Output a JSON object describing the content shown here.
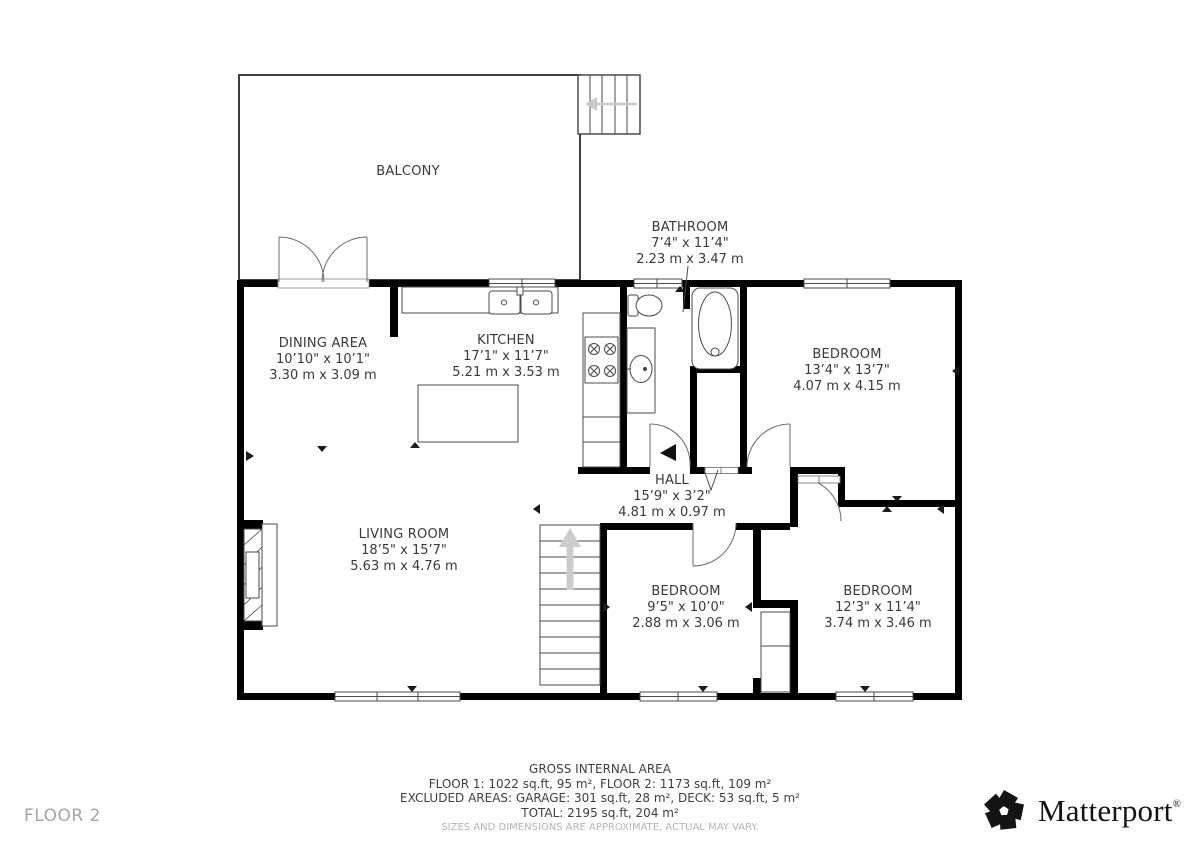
{
  "floor_label": "FLOOR 2",
  "rooms": [
    {
      "id": "balcony",
      "name": "BALCONY",
      "imperial": "",
      "metric": ""
    },
    {
      "id": "bathroom",
      "name": "BATHROOM",
      "imperial": "7’4\" x 11’4\"",
      "metric": "2.23 m x 3.47 m"
    },
    {
      "id": "dining",
      "name": "DINING AREA",
      "imperial": "10’10\" x 10’1\"",
      "metric": "3.30 m x 3.09 m"
    },
    {
      "id": "kitchen",
      "name": "KITCHEN",
      "imperial": "17’1\" x 11’7\"",
      "metric": "5.21 m x 3.53 m"
    },
    {
      "id": "bedroom-ne",
      "name": "BEDROOM",
      "imperial": "13’4\" x 13’7\"",
      "metric": "4.07 m x 4.15 m"
    },
    {
      "id": "hall",
      "name": "HALL",
      "imperial": "15’9\" x 3’2\"",
      "metric": "4.81 m x 0.97 m"
    },
    {
      "id": "living",
      "name": "LIVING ROOM",
      "imperial": "18’5\" x 15’7\"",
      "metric": "5.63 m x 4.76 m"
    },
    {
      "id": "bedroom-s",
      "name": "BEDROOM",
      "imperial": "9’5\" x 10’0\"",
      "metric": "2.88 m x 3.06 m"
    },
    {
      "id": "bedroom-se",
      "name": "BEDROOM",
      "imperial": "12’3\" x 11’4\"",
      "metric": "3.74 m x 3.46 m"
    }
  ],
  "footer": {
    "title": "GROSS INTERNAL AREA",
    "floors": "FLOOR 1: 1022 sq.ft, 95 m², FLOOR 2: 1173 sq.ft, 109 m²",
    "excluded": "EXCLUDED AREAS: GARAGE: 301 sq.ft, 28 m², DECK: 53 sq.ft, 5 m²",
    "total": "TOTAL: 2195 sq.ft, 204 m²",
    "disclaimer": "SIZES AND DIMENSIONS ARE APPROXIMATE, ACTUAL MAY VARY."
  },
  "brand": {
    "name": "Matterport",
    "registered": "®"
  },
  "colors": {
    "wall": "#000000",
    "thin_line": "#4a4a4a",
    "stair_arrow": "#c9c9c9",
    "muted_text": "#b4b4b4"
  }
}
